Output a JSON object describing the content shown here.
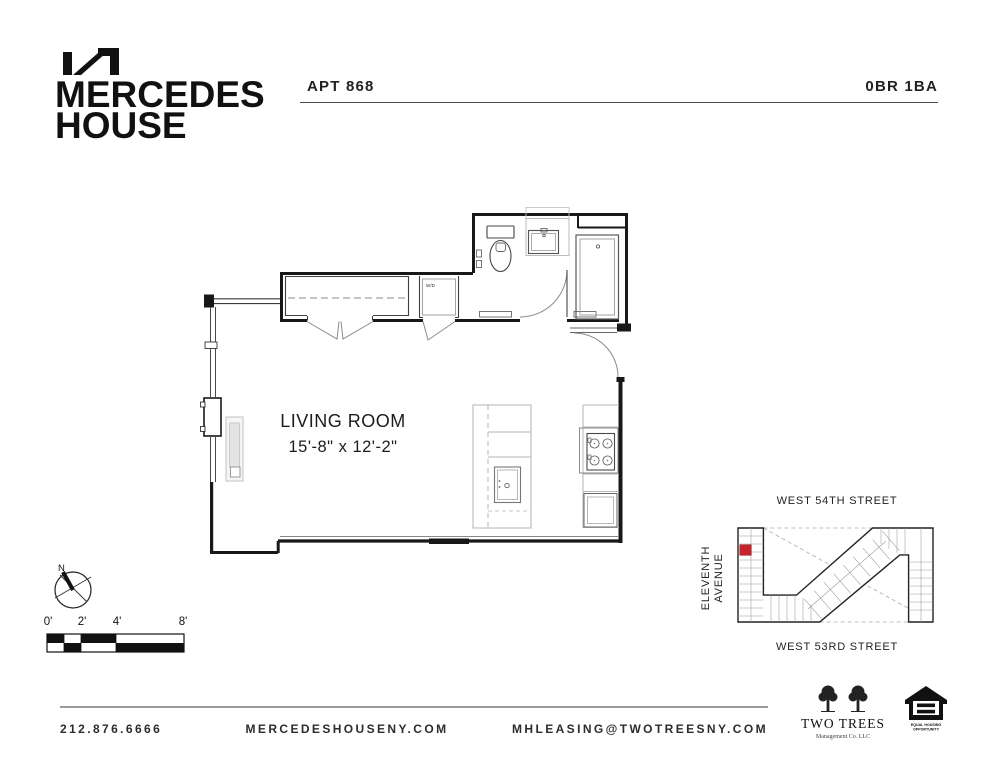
{
  "header": {
    "logo_line1": "MERCEDES",
    "logo_line2": "HOUSE",
    "apt_label": "APT 868",
    "unit_type": "0BR 1BA"
  },
  "floorplan": {
    "room_label": "LIVING ROOM",
    "room_dimensions": "15'-8\" x 12'-2\"",
    "wd_label": "W/D"
  },
  "compass": {
    "north_label": "N"
  },
  "scalebar": {
    "labels": [
      "0'",
      "2'",
      "4'",
      "8'"
    ]
  },
  "sitemap": {
    "street_top": "WEST 54TH STREET",
    "street_bottom": "WEST 53RD STREET",
    "avenue_line1": "ELEVENTH",
    "avenue_line2": "AVENUE",
    "unit_marker_color": "#c8222a"
  },
  "footer": {
    "phone": "212.876.6666",
    "website": "MERCEDESHOUSENY.COM",
    "email": "MHLEASING@TWOTREESNY.COM"
  },
  "logos": {
    "two_trees": {
      "name": "TWO TREES",
      "subtitle": "Management Co. LLC"
    },
    "equal_housing": {
      "line1": "EQUAL HOUSING",
      "line2": "OPPORTUNITY"
    }
  }
}
